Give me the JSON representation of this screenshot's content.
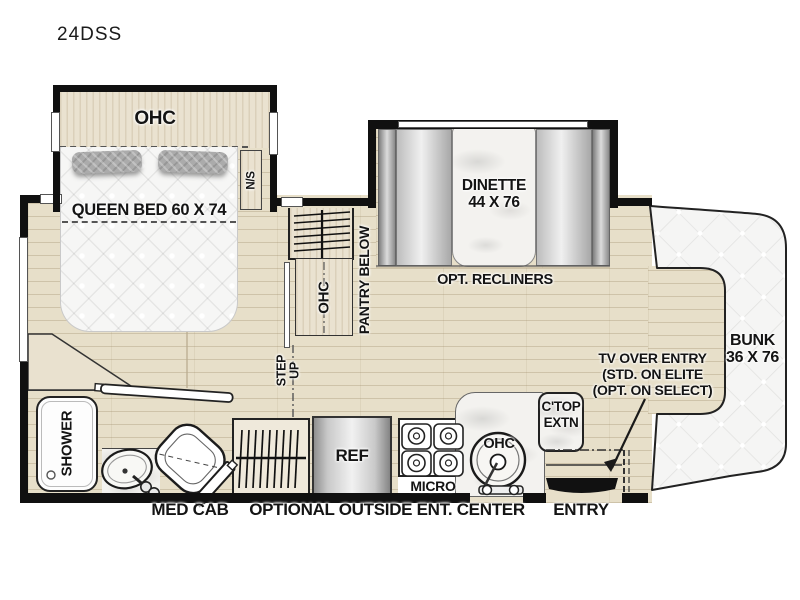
{
  "title": "24DSS",
  "floorplan": {
    "bedroom": {
      "overhead_cabinet": "OHC",
      "bed": "QUEEN BED 60 X 74",
      "nightstand": "N/S"
    },
    "midship": {
      "pantry": "PANTRY BELOW",
      "overhead_cabinet": "OHC",
      "step_line1": "STEP",
      "step_line2": "UP"
    },
    "dinette": {
      "name": "DINETTE",
      "size": "44 X 76",
      "option": "OPT. RECLINERS"
    },
    "cab": {
      "bunk_line1": "BUNK",
      "bunk_line2": "36 X 76",
      "tv_line1": "TV OVER ENTRY",
      "tv_line2": "(STD. ON ELITE",
      "tv_line3": "(OPT. ON SELECT)"
    },
    "kitchen": {
      "ctop_line1": "C'TOP",
      "ctop_line2": "EXTN",
      "refrigerator": "REF",
      "microwave": "MICRO",
      "sink_overhead": "OHC"
    },
    "bath": {
      "shower": "SHOWER",
      "med_cab": "MED CAB"
    },
    "exterior": {
      "outside_ent_center": "OPTIONAL OUTSIDE ENT. CENTER",
      "entry": "ENTRY"
    }
  },
  "colors": {
    "wall": "#101010",
    "floor": "#e7dfc9",
    "wood": "#eae2d0",
    "quilt": "#f6f6f5",
    "text": "#141414"
  }
}
